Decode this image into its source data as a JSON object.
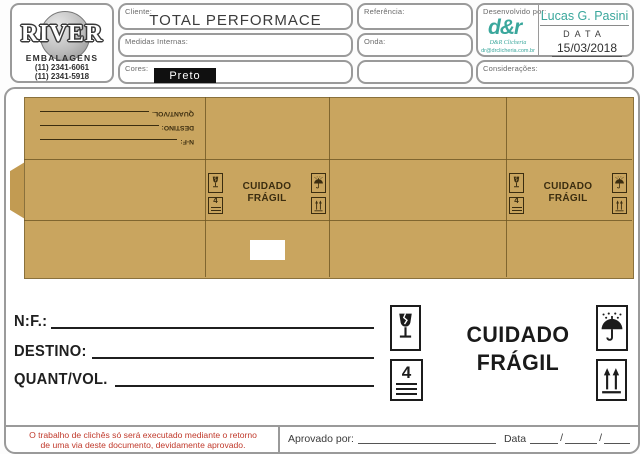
{
  "header": {
    "logo": {
      "title": "RIVER",
      "subtitle": "EMBALAGENS",
      "phone1": "(11) 2341-6061",
      "phone2": "(11) 2341-5918"
    },
    "cliente": {
      "label": "Cliente:",
      "value": "TOTAL PERFORMACE"
    },
    "medidas": {
      "label": "Medidas Internas:",
      "value": ""
    },
    "cores": {
      "label": "Cores:",
      "value": "Preto"
    },
    "referencia": {
      "label": "Referência:",
      "value": ""
    },
    "onda": {
      "label": "Onda:",
      "value": ""
    },
    "desenvolvido": {
      "label": "Desenvolvido por:",
      "developer": "Lucas G. Pasini",
      "data_label": "DATA",
      "date": "15/03/2018",
      "logo_glyph": "d&r",
      "logo_caption": "D&R Clicheria",
      "logo_email": "dr@drclicheria.com.br"
    },
    "consideracoes": {
      "label": "Considerações:"
    }
  },
  "box": {
    "rot_nf": "N-F:",
    "rot_destino": "DESTINO:",
    "rot_quant": "QUANT/VOL.",
    "cuidado": "CUIDADO",
    "fragil": "FRÁGIL",
    "stack": "4"
  },
  "form": {
    "nf_label": "N:F.:",
    "destino_label": "DESTINO:",
    "quant_label": "QUANT/VOL.",
    "cuidado": "CUIDADO",
    "fragil": "FRÁGIL",
    "stack": "4"
  },
  "footer": {
    "notice_line1": "O trabalho de clichês só será executado mediante o retorno",
    "notice_line2": "de uma via deste documento, devidamente aprovado.",
    "aprovado_label": "Aprovado por:",
    "data_label": "Data"
  },
  "colors": {
    "cardboard": "#c9a55f",
    "teal": "#3aa79c",
    "red_notice": "#c0392b",
    "badge_black": "#101010"
  }
}
